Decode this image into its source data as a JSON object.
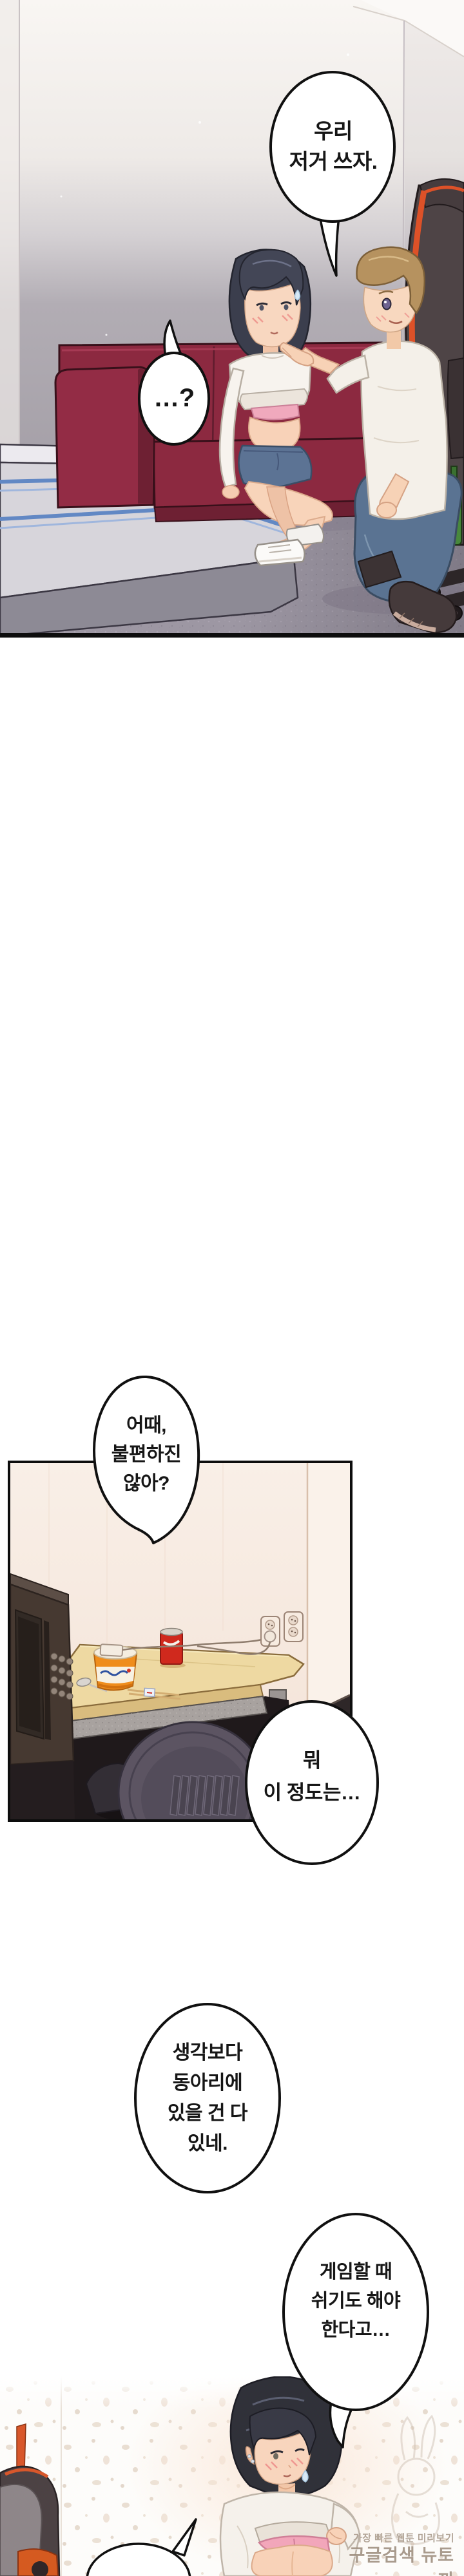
{
  "speech_bubbles": {
    "b1": {
      "text": "우리\n저거 쓰자."
    },
    "b2": {
      "text": "…?"
    },
    "b3": {
      "text": "어때,\n불편하진\n않아?"
    },
    "b4": {
      "text": "뭐\n이 정도는…"
    },
    "b5": {
      "text": "생각보다\n동아리에\n있을 건 다\n있네."
    },
    "b6": {
      "text": "게임할 때\n쉬기도 해야\n한다고…"
    }
  },
  "watermark": {
    "line1": "가장 빠른 웹툰 미리보기",
    "line2": "구글검색 뉴토끼"
  },
  "colors": {
    "bubble_fill": "#ffffff",
    "bubble_stroke": "#101010",
    "couch_red": "#8c2940",
    "carpet_gray": "#9d97a3",
    "panel2_wall": "#f8ece3",
    "desk_wood": "#eed9a2",
    "denim_blue": "#5a7392",
    "bra_pink": "#f2a6ba",
    "chair_orange": "#d8572b",
    "watermark_gray": "#a09080"
  }
}
